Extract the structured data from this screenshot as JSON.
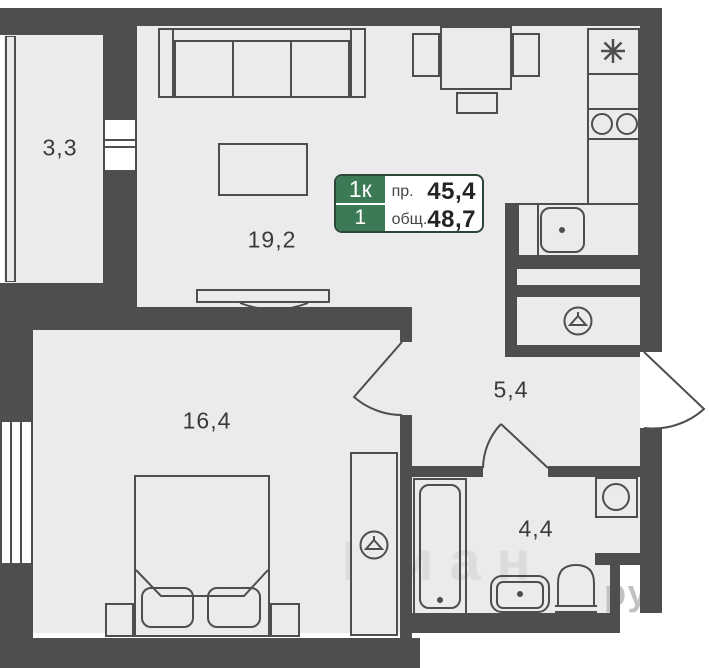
{
  "badge": {
    "rooms": "1к",
    "floor": "1",
    "row1_label": "пр.",
    "row1_value": "45,4",
    "row2_label": "общ.",
    "row2_value": "48,7"
  },
  "rooms": {
    "balcony": "3,3",
    "living_kitchen": "19,2",
    "bedroom": "16,4",
    "hallway": "5,4",
    "bathroom": "4,4"
  },
  "watermark": {
    "main": "Циан",
    "suffix": "ру"
  },
  "icons": {
    "fridge": "asterisk-icon",
    "stove": "two-burner-icon",
    "hall_closet": "hanger-icon",
    "bedroom_wardrobe": "hanger-icon",
    "washing_machine": "drum-circle-icon"
  },
  "colors": {
    "wall": "#4e4e50",
    "floor": "#ebebed",
    "badge_green": "#3b7a54",
    "badge_border": "#2c4638",
    "text": "#3a3a3c"
  }
}
